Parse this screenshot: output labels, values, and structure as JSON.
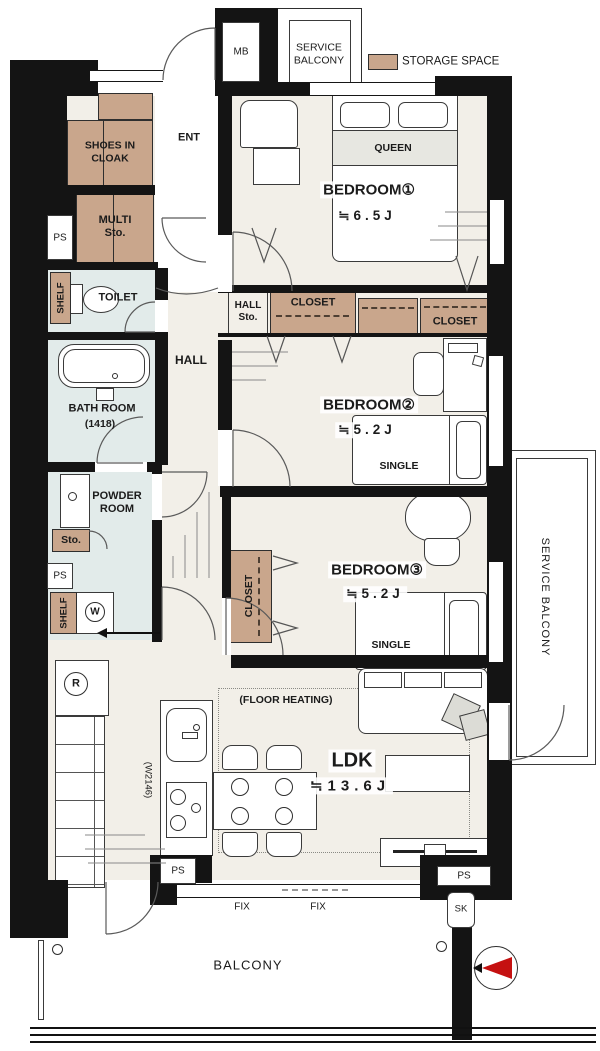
{
  "colors": {
    "wall": "#141414",
    "floor": "#F2EFE8",
    "wet_area": "#E2EBEA",
    "storage": "#C9A68C",
    "accent_red": "#C51111"
  },
  "legend": {
    "storage_space": "STORAGE SPACE"
  },
  "common": {
    "ps": "PS",
    "shelf": "SHELF",
    "closet": "CLOSET",
    "single": "SINGLE",
    "fix": "FIX"
  },
  "top": {
    "mb": "MB",
    "service_balcony": "SERVICE BALCONY"
  },
  "entry": {
    "ent": "ENT",
    "shoes_in_cloak": "SHOES IN CLOAK",
    "multi_sto": "MULTI Sto."
  },
  "hall": {
    "name": "HALL",
    "hall_sto": "HALL Sto."
  },
  "wet": {
    "toilet": "TOILET",
    "bath_room": "BATH ROOM",
    "bath_size": "(1418)",
    "powder_room": "POWDER ROOM",
    "sto": "Sto.",
    "washer": "W"
  },
  "bedroom1": {
    "name": "BEDROOM①",
    "size": "≒6.5J",
    "bed": "QUEEN"
  },
  "bedroom2": {
    "name": "BEDROOM②",
    "size": "≒5.2J"
  },
  "bedroom3": {
    "name": "BEDROOM③",
    "size": "≒5.2J"
  },
  "ldk": {
    "name": "LDK",
    "size": "≒13.6J",
    "floor_heating": "(FLOOR HEATING)",
    "kitchen_width": "(W2146)",
    "fridge": "R"
  },
  "balcony": {
    "name": "BALCONY",
    "sk": "SK"
  }
}
